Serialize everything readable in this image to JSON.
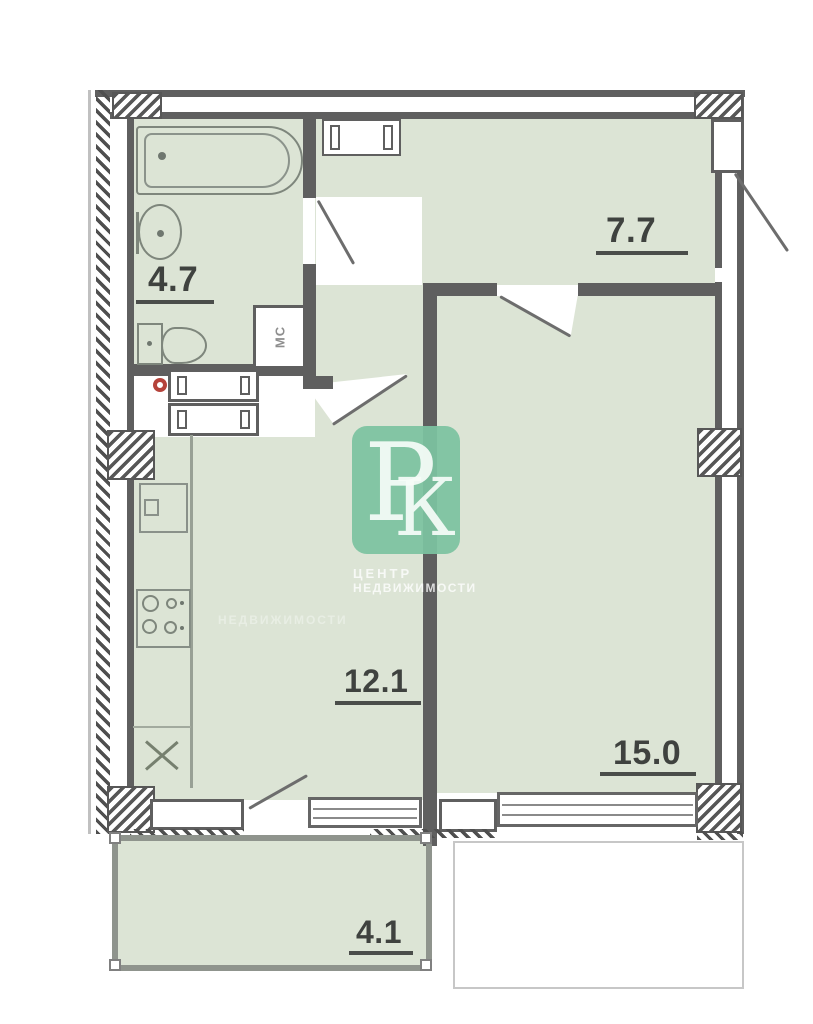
{
  "rooms": {
    "bathroom": {
      "area": "4.7"
    },
    "hallway": {
      "area": "7.7"
    },
    "kitchen": {
      "area": "12.1"
    },
    "living_room": {
      "area": "15.0"
    },
    "balcony": {
      "area": "4.1"
    }
  },
  "labels": {
    "washer_closet": "МС"
  },
  "watermark": {
    "letter_p": "Р",
    "letter_k": "К",
    "caption_line1": "ЦЕНТР",
    "caption_line2": "НЕДВИЖИМОСТИ"
  },
  "colors": {
    "floor": "#dce4d5",
    "wall": "#5f5f5f",
    "watermark_green": "#7cc3a0",
    "fixture_outline": "#7e867c",
    "red_marker": "#b5433b"
  }
}
